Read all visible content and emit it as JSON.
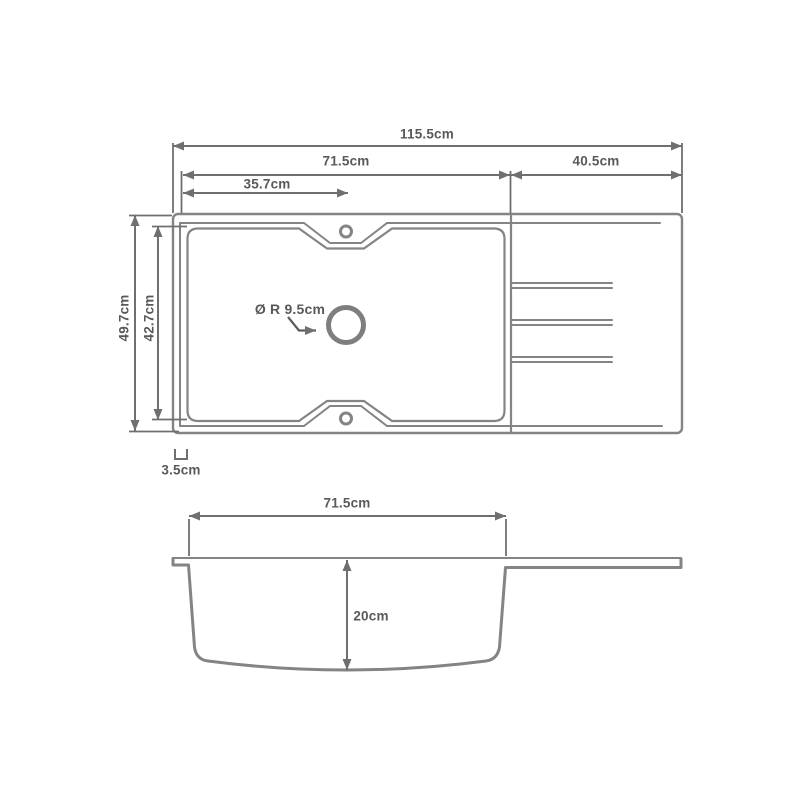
{
  "drawing": {
    "type": "technical-dimension-drawing",
    "subject": "kitchen sink with single bowl and drainer board",
    "views": [
      "top view",
      "side section view"
    ],
    "colors": {
      "background": "#ffffff",
      "outline": "#848484",
      "dimension_lines": "#6e6f71",
      "label_text": "#58595b"
    },
    "top_view": {
      "overall_width": "115.5cm",
      "bowl_section_width": "71.5cm",
      "drainer_width": "40.5cm",
      "bowl_center_offset": "35.7cm",
      "overall_depth": "49.7cm",
      "bowl_depth": "42.7cm",
      "drain_hole": "Ø R 9.5cm",
      "corner_radius": "3.5cm"
    },
    "side_view": {
      "bowl_width": "71.5cm",
      "bowl_height": "20cm"
    }
  }
}
